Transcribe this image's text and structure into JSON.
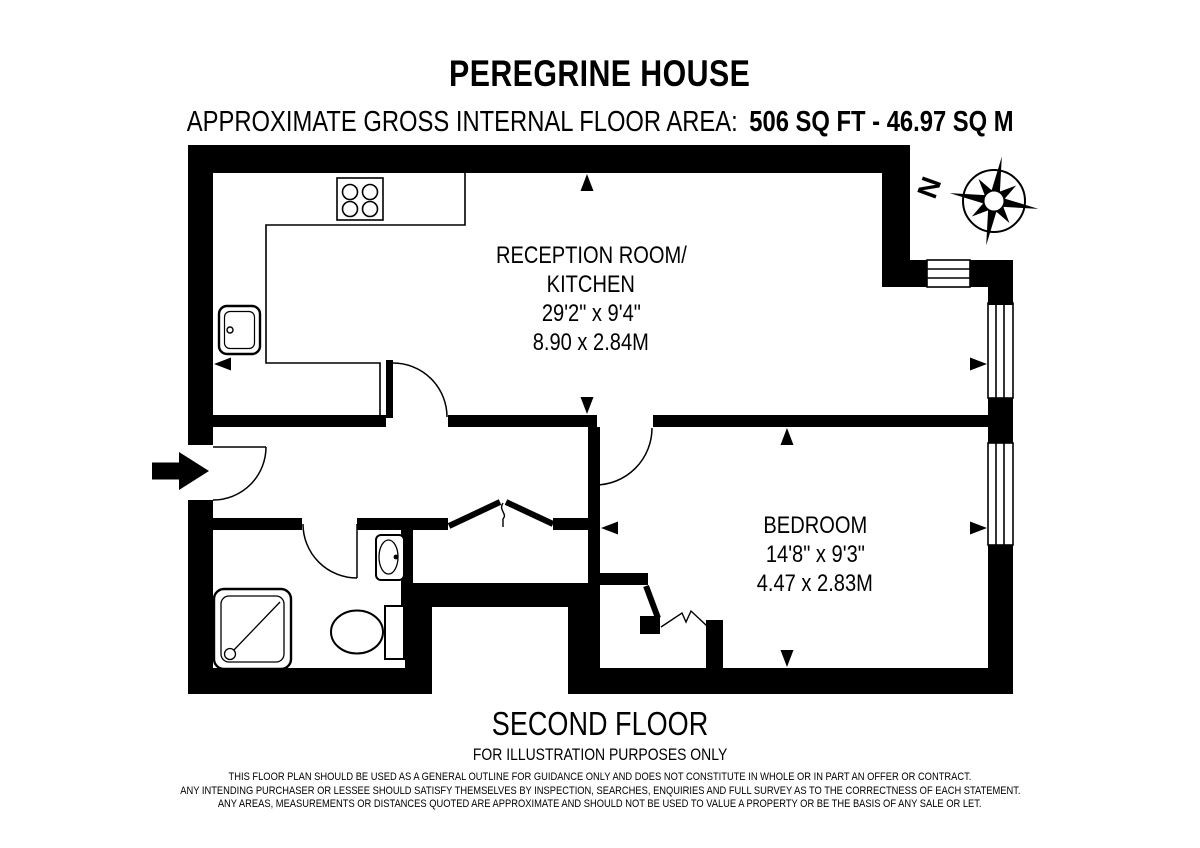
{
  "header": {
    "title": "PEREGRINE HOUSE",
    "area_label": "APPROXIMATE GROSS INTERNAL FLOOR AREA:",
    "area_value": "506 SQ FT - 46.97 SQ M"
  },
  "rooms": {
    "reception": {
      "name_line1": "RECEPTION ROOM/",
      "name_line2": "KITCHEN",
      "dimensions_imperial": "29'2\" x 9'4\"",
      "dimensions_metric": "8.90 x 2.84M"
    },
    "bedroom": {
      "name": "BEDROOM",
      "dimensions_imperial": "14'8\" x 9'3\"",
      "dimensions_metric": "4.47 x 2.83M"
    }
  },
  "compass": {
    "north_label": "N"
  },
  "footer": {
    "floor_label": "SECOND FLOOR",
    "purpose_note": "FOR ILLUSTRATION PURPOSES ONLY",
    "disclaimer_lines": [
      "THIS FLOOR PLAN SHOULD BE USED AS A GENERAL OUTLINE FOR GUIDANCE ONLY AND DOES NOT CONSTITUTE IN WHOLE OR IN PART AN OFFER OR CONTRACT.",
      "ANY INTENDING PURCHASER OR LESSEE SHOULD SATISFY THEMSELVES BY INSPECTION, SEARCHES, ENQUIRIES AND FULL SURVEY AS TO THE CORRECTNESS OF EACH STATEMENT.",
      "ANY AREAS, MEASUREMENTS OR DISTANCES QUOTED ARE APPROXIMATE AND SHOULD NOT BE USED TO VALUE A PROPERTY OR BE THE BASIS OF ANY SALE OR LET."
    ]
  },
  "colors": {
    "ink": "#000000",
    "background": "#ffffff"
  }
}
